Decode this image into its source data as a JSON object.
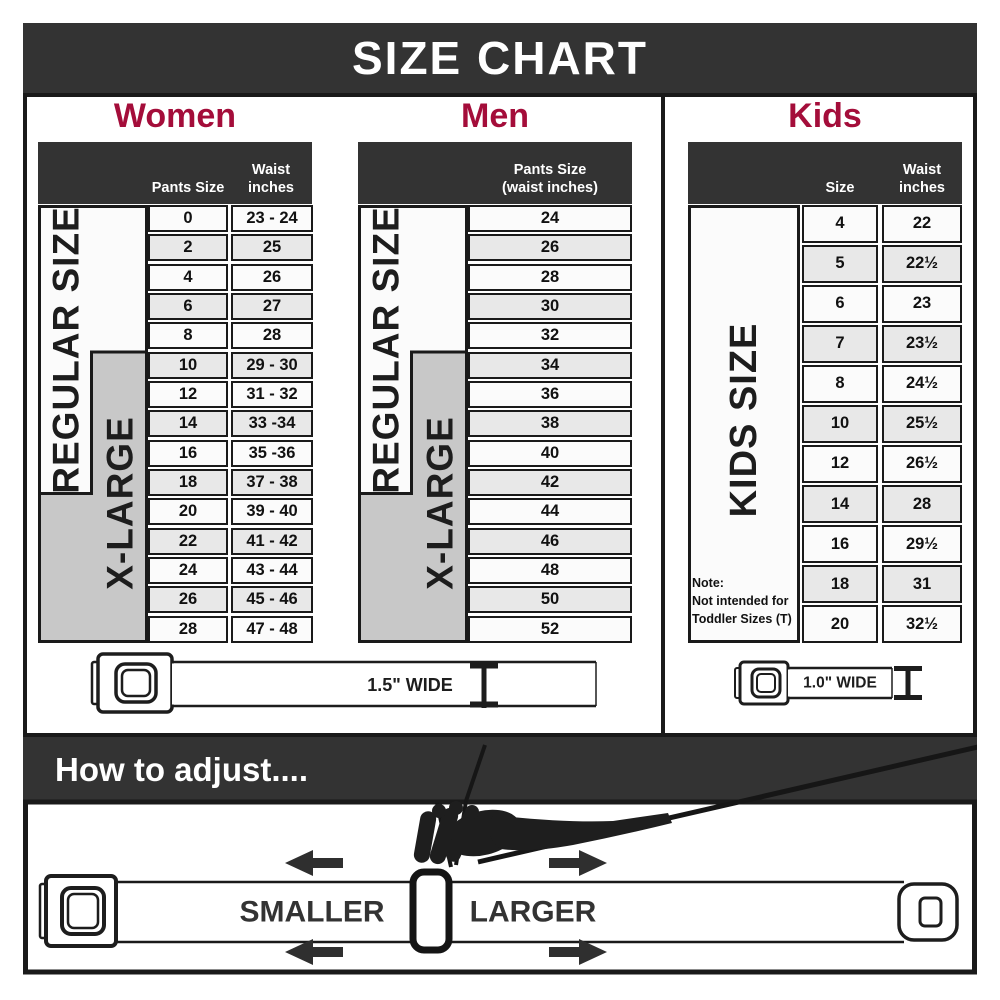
{
  "title": "SIZE CHART",
  "colors": {
    "charcoal": "#333333",
    "crimson": "#a40d3a",
    "border_ink": "#1a1a1a",
    "cell_light": "#fbfbfb",
    "cell_shaded": "#e8e8e8",
    "group_gray": "#c8c8c8"
  },
  "women": {
    "title": "Women",
    "size_groups": {
      "regular": "REGULAR SIZE",
      "xlarge": "X-LARGE"
    },
    "columns": {
      "size": "Pants Size",
      "waist_line1": "Waist",
      "waist_line2": "inches"
    },
    "rows": [
      [
        "0",
        "23 - 24"
      ],
      [
        "2",
        "25"
      ],
      [
        "4",
        "26"
      ],
      [
        "6",
        "27"
      ],
      [
        "8",
        "28"
      ],
      [
        "10",
        "29 - 30"
      ],
      [
        "12",
        "31 - 32"
      ],
      [
        "14",
        "33 -34"
      ],
      [
        "16",
        "35 -36"
      ],
      [
        "18",
        "37 - 38"
      ],
      [
        "20",
        "39 - 40"
      ],
      [
        "22",
        "41 - 42"
      ],
      [
        "24",
        "43 - 44"
      ],
      [
        "26",
        "45 - 46"
      ],
      [
        "28",
        "47 - 48"
      ]
    ]
  },
  "men": {
    "title": "Men",
    "size_groups": {
      "regular": "REGULAR SIZE",
      "xlarge": "X-LARGE"
    },
    "column_header": [
      "Pants Size",
      "(waist inches)"
    ],
    "rows": [
      "24",
      "26",
      "28",
      "30",
      "32",
      "34",
      "36",
      "38",
      "40",
      "42",
      "44",
      "46",
      "48",
      "50",
      "52"
    ]
  },
  "kids": {
    "title": "Kids",
    "size_group": "KIDS SIZE",
    "columns": {
      "size": "Size",
      "waist_line1": "Waist",
      "waist_line2": "inches"
    },
    "note_lines": [
      "Note:",
      "Not intended for",
      "Toddler Sizes (T)"
    ],
    "rows": [
      [
        "4",
        "22"
      ],
      [
        "5",
        "22½"
      ],
      [
        "6",
        "23"
      ],
      [
        "7",
        "23½"
      ],
      [
        "8",
        "24½"
      ],
      [
        "10",
        "25½"
      ],
      [
        "12",
        "26½"
      ],
      [
        "14",
        "28"
      ],
      [
        "16",
        "29½"
      ],
      [
        "18",
        "31"
      ],
      [
        "20",
        "32½"
      ]
    ]
  },
  "belts": {
    "adult_width_label": "1.5\" WIDE",
    "kids_width_label": "1.0\" WIDE"
  },
  "adjust": {
    "title": "How to adjust....",
    "smaller_label": "SMALLER",
    "larger_label": "LARGER"
  }
}
